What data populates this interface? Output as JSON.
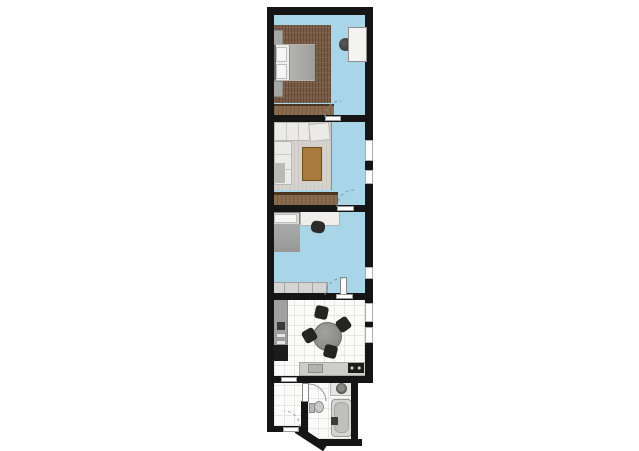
{
  "canvas": {
    "width": 639,
    "height": 451,
    "background": "#ffffff"
  },
  "colors": {
    "wall": "#151515",
    "floor-blue": "#a8d6e8",
    "tile": "#fbfbfa",
    "tile-line": "#e6e6e4",
    "rug-brown": "#7a5b46",
    "rug-light": "#d6d3ce",
    "wood-light": "#a87a3c",
    "wood-mid": "#8b6b4d",
    "wood-dark": "#4a3723",
    "white-furniture": "#efeeec",
    "gray-furniture": "#a6a6a4",
    "gray-dark": "#2c2c2a",
    "appliance-black": "#1c1c1a",
    "counter-gray": "#cdcdcb",
    "steel-gray": "#9d9d9b",
    "arc": "#7d97a8",
    "outline": "#9a9a98"
  },
  "floor_plan": {
    "rooms": [
      {
        "name": "bedroom",
        "floor": "blue",
        "furniture": [
          "double-bed",
          "pillow",
          "pillow",
          "nightstand",
          "nightstand",
          "area-rug",
          "dresser",
          "wardrobe",
          "plant"
        ]
      },
      {
        "name": "living-room",
        "floor": "blue",
        "furniture": [
          "corner-sofa",
          "armchair",
          "coffee-table",
          "area-rug",
          "sideboard"
        ]
      },
      {
        "name": "small-bedroom",
        "floor": "blue",
        "furniture": [
          "single-bed",
          "pillow",
          "desk",
          "desk-chair",
          "low-cabinet-row"
        ]
      },
      {
        "name": "kitchen-dining",
        "floor": "white-tile",
        "furniture": [
          "tall-counter",
          "refrigerator",
          "round-dining-table",
          "dining-chair",
          "dining-chair",
          "dining-chair",
          "dining-chair",
          "lower-counter",
          "sink",
          "cooktop"
        ]
      },
      {
        "name": "entry-hall",
        "floor": "white-tile",
        "furniture": []
      },
      {
        "name": "bathroom",
        "floor": "white-tile",
        "furniture": [
          "washbasin-counter",
          "washbasin",
          "toilet",
          "bathtub",
          "faucet"
        ]
      }
    ],
    "door_count": 6,
    "window_count": 5
  }
}
